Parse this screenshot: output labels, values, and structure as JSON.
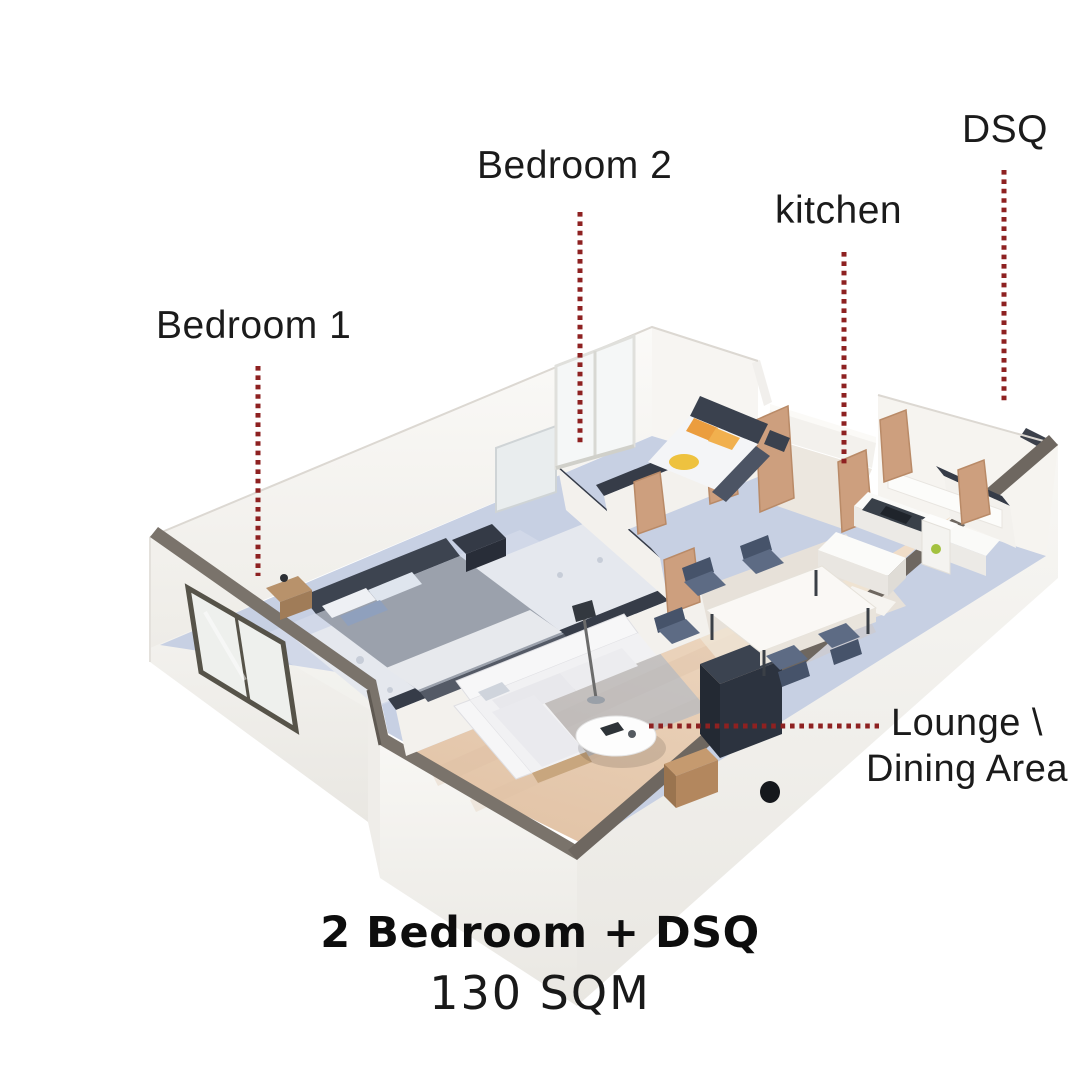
{
  "poster": {
    "room_labels": {
      "bedroom_1": "Bedroom 1",
      "bedroom_2": "Bedroom 2",
      "kitchen": "kitchen",
      "dsq": "DSQ",
      "lounge_line_1": "Lounge \\",
      "lounge_line_2": "Dining Area"
    },
    "footer": {
      "title": "2 Bedroom + DSQ",
      "area": "130 SQM"
    },
    "colors": {
      "background": "#FFFFFF",
      "label_text": "#1B1B1B",
      "leader_dots": "#8E2121",
      "floor_blue": "#C7D0E3",
      "floor_wood": "#E8D0B8",
      "door_tan": "#CD9F7E",
      "wall_white": "#F7F6F3",
      "wall_top_dark": "#363C48",
      "front_wall_band": "#7A736B"
    }
  }
}
